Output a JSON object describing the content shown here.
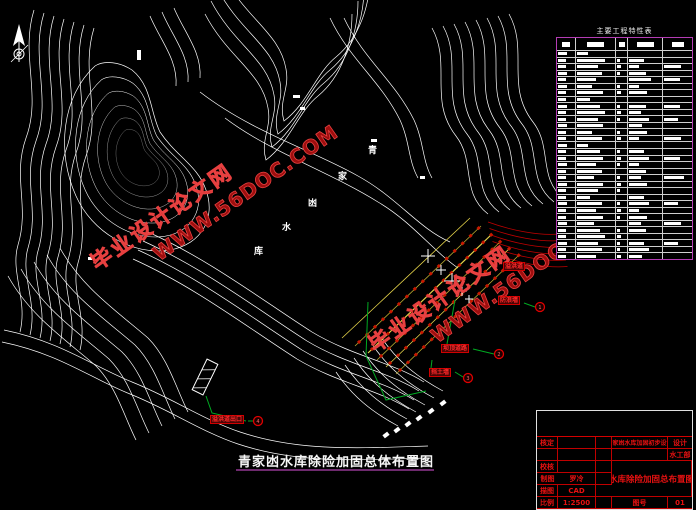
{
  "drawing": {
    "bottom_title": "青家凼水库除险加固总体布置图",
    "reservoir_name_chars": [
      "青",
      "家",
      "凼",
      "水",
      "库"
    ]
  },
  "watermark": {
    "line1": "毕业设计论文网",
    "line2": "WWW.56DOC.COM"
  },
  "spec_table": {
    "title": "主要工程特性表",
    "columns": 5,
    "rows": [
      [
        0.5,
        0.45,
        0.6,
        0.5,
        0.45
      ],
      [
        0.55,
        0.3,
        0,
        0,
        0
      ],
      [
        0.5,
        0.75,
        0.3,
        0.45,
        0
      ],
      [
        0.5,
        0.55,
        0.35,
        0.3,
        0.6
      ],
      [
        0.55,
        0.65,
        0.3,
        0.5,
        0
      ],
      [
        0.5,
        0.5,
        0,
        0.65,
        0.55
      ],
      [
        0.55,
        0.4,
        0.3,
        0.3,
        0
      ],
      [
        0.5,
        0.7,
        0.35,
        0.55,
        0
      ],
      [
        0.5,
        0.35,
        0,
        0,
        0
      ],
      [
        0.55,
        0.6,
        0.3,
        0.5,
        0.55
      ],
      [
        0.5,
        0.75,
        0.35,
        0.35,
        0
      ],
      [
        0.5,
        0.55,
        0.3,
        0.6,
        0.5
      ],
      [
        0.55,
        0.7,
        0,
        0.4,
        0
      ],
      [
        0.5,
        0.4,
        0.3,
        0.55,
        0
      ],
      [
        0.5,
        0.65,
        0.35,
        0.3,
        0.6
      ],
      [
        0.55,
        0.3,
        0,
        0,
        0
      ],
      [
        0.5,
        0.6,
        0.3,
        0.45,
        0
      ],
      [
        0.5,
        0.7,
        0.35,
        0.6,
        0.55
      ],
      [
        0.55,
        0.5,
        0.3,
        0.3,
        0
      ],
      [
        0.5,
        0.65,
        0,
        0.5,
        0
      ],
      [
        0.5,
        0.45,
        0.3,
        0.35,
        0.7
      ],
      [
        0.55,
        0.7,
        0.35,
        0.55,
        0
      ],
      [
        0.5,
        0.55,
        0.3,
        0,
        0
      ],
      [
        0.5,
        0.35,
        0,
        0.45,
        0
      ],
      [
        0.55,
        0.65,
        0.3,
        0.6,
        0.5
      ],
      [
        0.5,
        0.5,
        0.35,
        0.3,
        0
      ],
      [
        0.5,
        0.7,
        0.3,
        0.55,
        0
      ],
      [
        0.55,
        0.45,
        0,
        0.35,
        0.6
      ],
      [
        0.5,
        0.6,
        0.3,
        0.5,
        0
      ],
      [
        0.5,
        0.75,
        0.35,
        0,
        0
      ],
      [
        0.55,
        0.55,
        0.3,
        0.45,
        0.5
      ],
      [
        0.5,
        0.65,
        0.3,
        0.6,
        0
      ],
      [
        0.5,
        0.5,
        0.35,
        0.4,
        0
      ]
    ]
  },
  "title_block": {
    "project": "青家凼水库加固初步设计",
    "design_label": "设计",
    "dept": "水工部",
    "sheet_title": "水库除险加固总布置图",
    "fields": [
      {
        "label": "核定",
        "value": ""
      },
      {
        "label": "",
        "value": ""
      },
      {
        "label": "校核",
        "value": ""
      },
      {
        "label": "制图",
        "value": "罗冷"
      },
      {
        "label": "描图",
        "value": "CAD"
      },
      {
        "label": "比例",
        "value": "1:2500"
      }
    ],
    "sheet_no_label": "图号",
    "sheet_no": "01"
  },
  "annotations": [
    {
      "num": "1",
      "label": "防浪墙"
    },
    {
      "num": "2",
      "label": "坝顶道路"
    },
    {
      "num": "3",
      "label": "挡土墙"
    },
    {
      "num": "4",
      "label": "溢洪道出口"
    },
    {
      "num": "",
      "label": "溢洪道"
    }
  ],
  "colors": {
    "background": "#000000",
    "contour": "#ffffff",
    "watermark_red": "#b41414",
    "table_border_magenta": "#b43cb4",
    "title_block_red": "#d40000",
    "dam_yellow": "#e6d44a",
    "leader_green": "#00aa22"
  }
}
